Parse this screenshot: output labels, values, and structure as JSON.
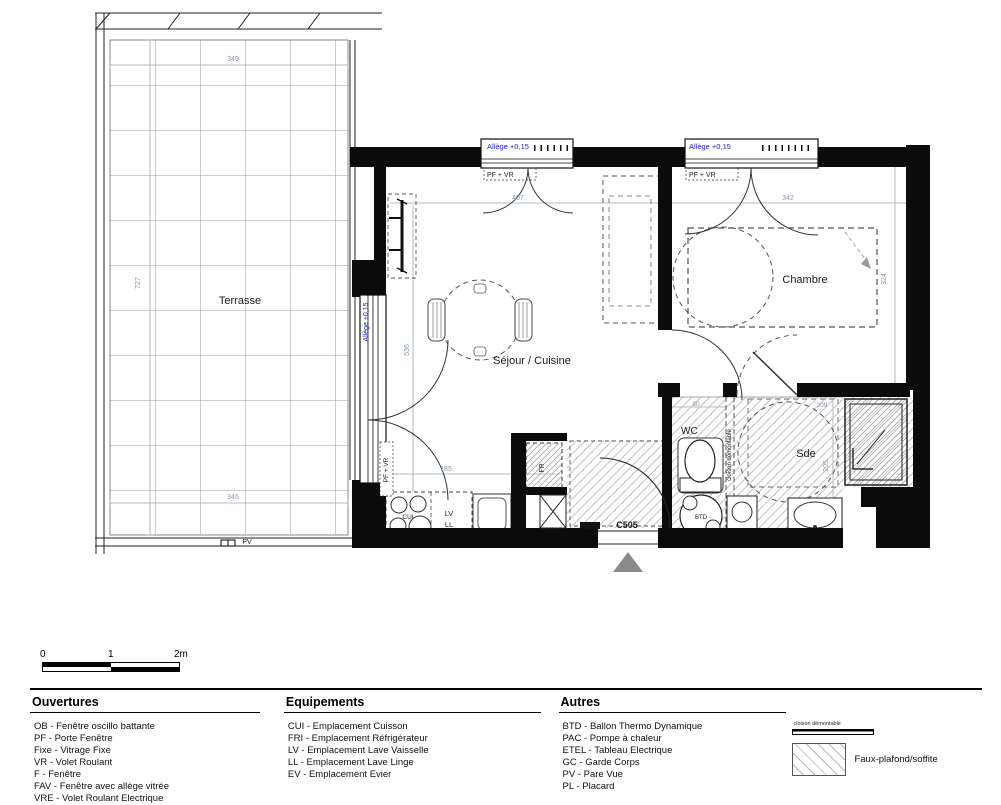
{
  "colors": {
    "allege_blue": "#2525c8",
    "dim_gray": "#8795a6",
    "wall_black": "#0b0b0b",
    "entrance_triangle": "#8a8a8a",
    "hatch_gray": "#c4c4c4"
  },
  "plan": {
    "unit_label": "C505",
    "rooms": {
      "terrasse": "Terrasse",
      "sejour": "Séjour / Cuisine",
      "chambre": "Chambre",
      "wc": "WC",
      "sde": "Sde"
    },
    "window_label": "PF + VR",
    "allege_label": "Allège +0,15",
    "partition_label": "cloison démontable",
    "equipment": {
      "cui": "CUI",
      "lv": "LV",
      "ll": "LL",
      "fr": "FR",
      "btd": "BTD"
    },
    "dims": {
      "terrace_top": "349",
      "terrace_left": "727",
      "terrace_bottom": "346",
      "pare_vue": "PV",
      "window_sejour": "407",
      "window_chambre": "342",
      "sejour_height": "536",
      "sejour_width": "185",
      "wc_width": "80",
      "chambre_height": "324",
      "sde_top": "209",
      "sde_right": "205"
    }
  },
  "scalebar": {
    "t0": "0",
    "t1": "1",
    "t2": "2m"
  },
  "legend": {
    "columns": [
      {
        "title": "Ouvertures",
        "items": [
          "OB - Fenêtre oscillo battante",
          "PF - Porte Fenêtre",
          "Fixe - Vitrage Fixe",
          "VR - Volet Roulant",
          "F - Fenêtre",
          "FAV - Fenêtre avec allège vitrée",
          "VRE - Volet Roulant Electrique"
        ]
      },
      {
        "title": "Equipements",
        "items": [
          "CUI - Emplacement Cuisson",
          "FRI - Emplacement Réfrigérateur",
          "LV - Emplacement Lave Vaisselle",
          "LL - Emplacement Lave Linge",
          "EV - Emplacement Evier"
        ]
      },
      {
        "title": "Autres",
        "items": [
          "BTD - Ballon Thermo Dynamique",
          "PAC - Pompe à chaleur",
          "ETEL - Tableau Electrique",
          "GC - Garde Corps",
          "PV - Pare Vue",
          "PL - Placard"
        ]
      }
    ],
    "partition_symbol_label": "cloison démontable",
    "hatch_symbol_label": "Faux-plafond/soffite"
  }
}
